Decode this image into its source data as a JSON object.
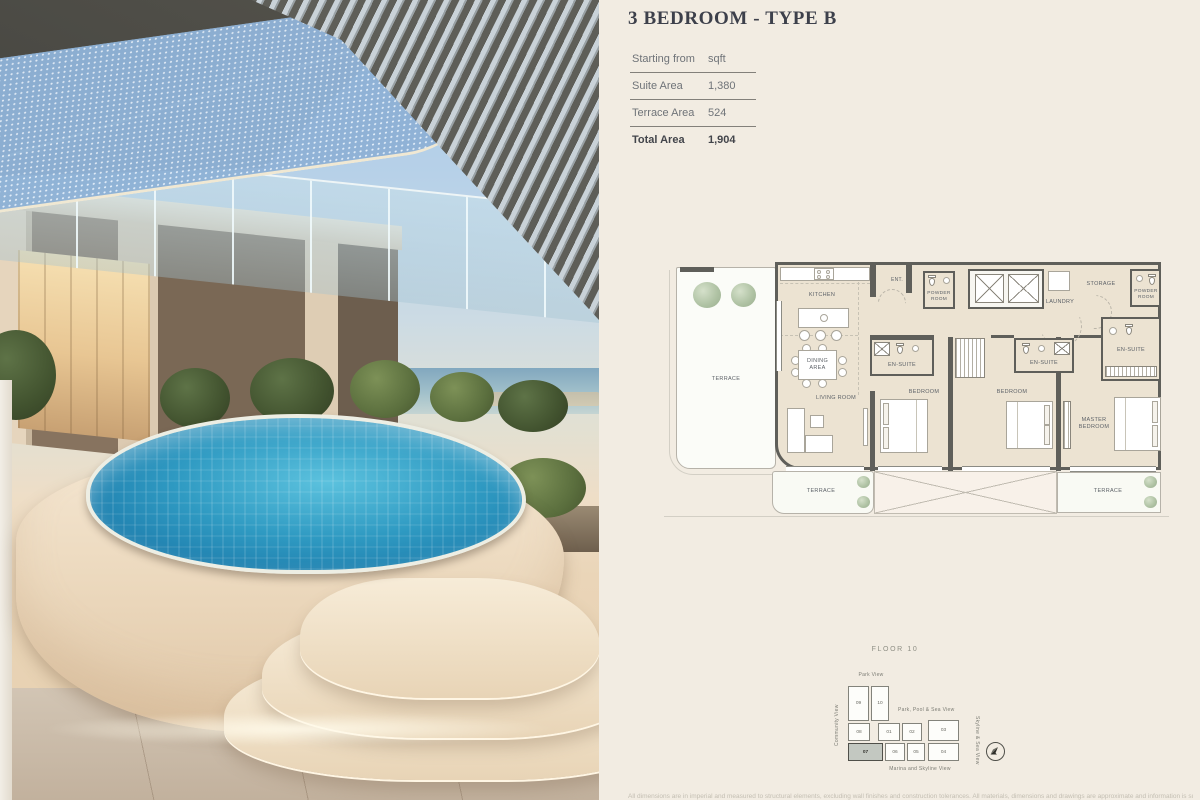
{
  "page": {
    "background": "#f2ece2",
    "accent_text": "#3d404b"
  },
  "header": {
    "title": "3 BEDROOM - TYPE B"
  },
  "area_table": {
    "header": {
      "label": "Starting from",
      "unit": "sqft"
    },
    "rows": [
      {
        "label": "Suite Area",
        "value": "1,380"
      },
      {
        "label": "Terrace Area",
        "value": "524"
      },
      {
        "label": "Total Area",
        "value": "1,904"
      }
    ]
  },
  "floor_plan": {
    "labels": {
      "terrace": "TERRACE",
      "kitchen": "KITCHEN",
      "ent": "ENT.",
      "powder_room": "POWDER\nROOM",
      "laundry": "LAUNDRY",
      "storage": "STORAGE",
      "en_suite": "EN-SUITE",
      "dining_area": "DINING\nAREA",
      "living_room": "LIVING ROOM",
      "bedroom": "BEDROOM",
      "master_bedroom": "MASTER\nBEDROOM"
    }
  },
  "key_plan": {
    "title": "FLOOR 10",
    "views": {
      "top": "Park View",
      "left": "Community View",
      "center": "Park, Pool & Sea View",
      "right": "Skyline & Sea View",
      "bottom": "Marina and Skyline View"
    },
    "highlighted_unit": "07",
    "units": [
      "09",
      "10",
      "08",
      "01",
      "02",
      "03",
      "07",
      "06",
      "05",
      "04"
    ]
  },
  "footer": {
    "disclaimer": "All dimensions are in imperial and measured to structural elements, excluding wall finishes and construction tolerances. All materials, dimensions and drawings are approximate and information is subject to change without notice."
  }
}
